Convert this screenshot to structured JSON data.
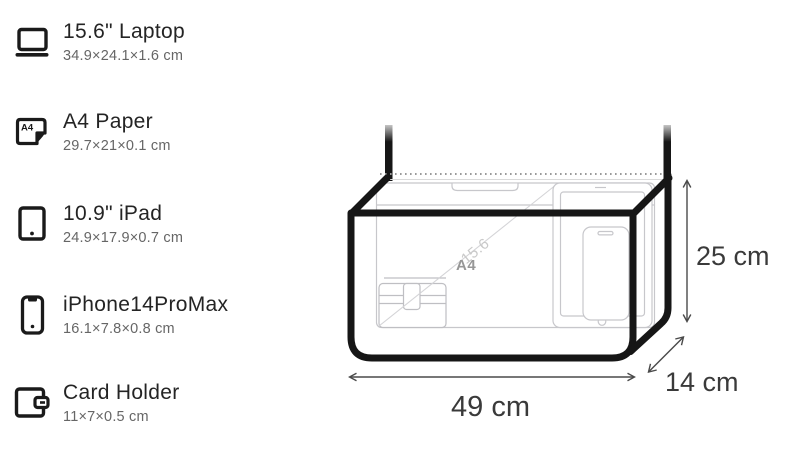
{
  "sidebar": {
    "items": [
      {
        "icon": "laptop-icon",
        "name": "15.6\" Laptop",
        "dimensions": "34.9×24.1×1.6 cm"
      },
      {
        "icon": "a4-paper-icon",
        "name": "A4 Paper",
        "dimensions": "29.7×21×0.1 cm"
      },
      {
        "icon": "ipad-icon",
        "name": "10.9\" iPad",
        "dimensions": "24.9×17.9×0.7 cm"
      },
      {
        "icon": "iphone-icon",
        "name": "iPhone14ProMax",
        "dimensions": "16.1×7.8×0.8 cm"
      },
      {
        "icon": "card-holder-icon",
        "name": "Card Holder",
        "dimensions": "11×7×0.5 cm"
      }
    ],
    "a4_icon_text": "A4"
  },
  "bag": {
    "width_label": "49 cm",
    "height_label": "25 cm",
    "depth_label": "14 cm",
    "interior_labels": {
      "paper": "A4",
      "laptop_diagonal": "15.6"
    }
  },
  "colors": {
    "bag_outline": "#161616",
    "title_text": "#242424",
    "subtitle_text": "#666666",
    "dimension_text": "#3a3a3a",
    "arrow": "#4a4a4a",
    "contents_outline": "#c7c7cb",
    "zipper_dots": "#9a9a9a"
  }
}
